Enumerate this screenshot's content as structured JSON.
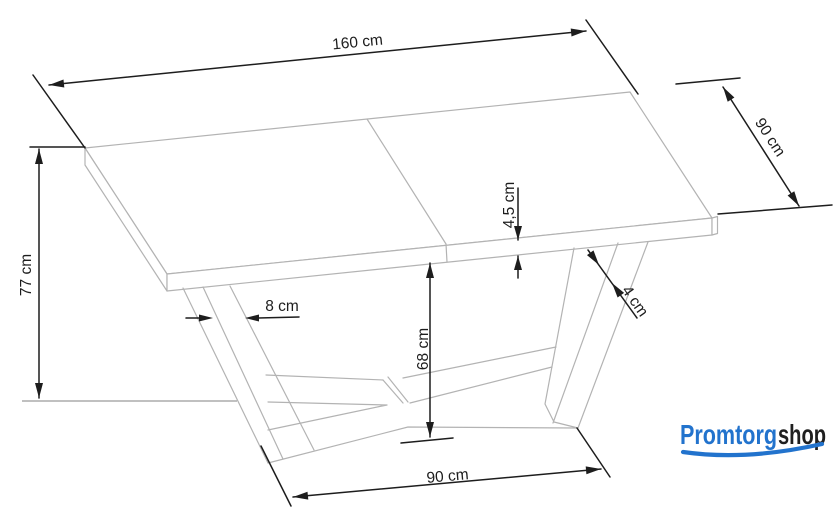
{
  "drawing": {
    "type": "furniture dimension diagram",
    "subject": "extendable dining table with V-shaped legs",
    "colors": {
      "outline": "#b3b3b3",
      "dimension": "#1d1d1d",
      "ground_line": "#9a9a9a"
    },
    "dimensions": {
      "table_length": "160 cm",
      "table_depth": "90 cm",
      "table_height": "77 cm",
      "top_thickness": "4,5 cm",
      "leg_width": "8 cm",
      "clearance_height": "68 cm",
      "leg_thickness": "4 cm",
      "base_length": "90 cm"
    }
  },
  "logo": {
    "part1": "Promtorg",
    "part2": "shop",
    "color_primary": "#2273cd",
    "color_dark": "#1f1f1f"
  }
}
